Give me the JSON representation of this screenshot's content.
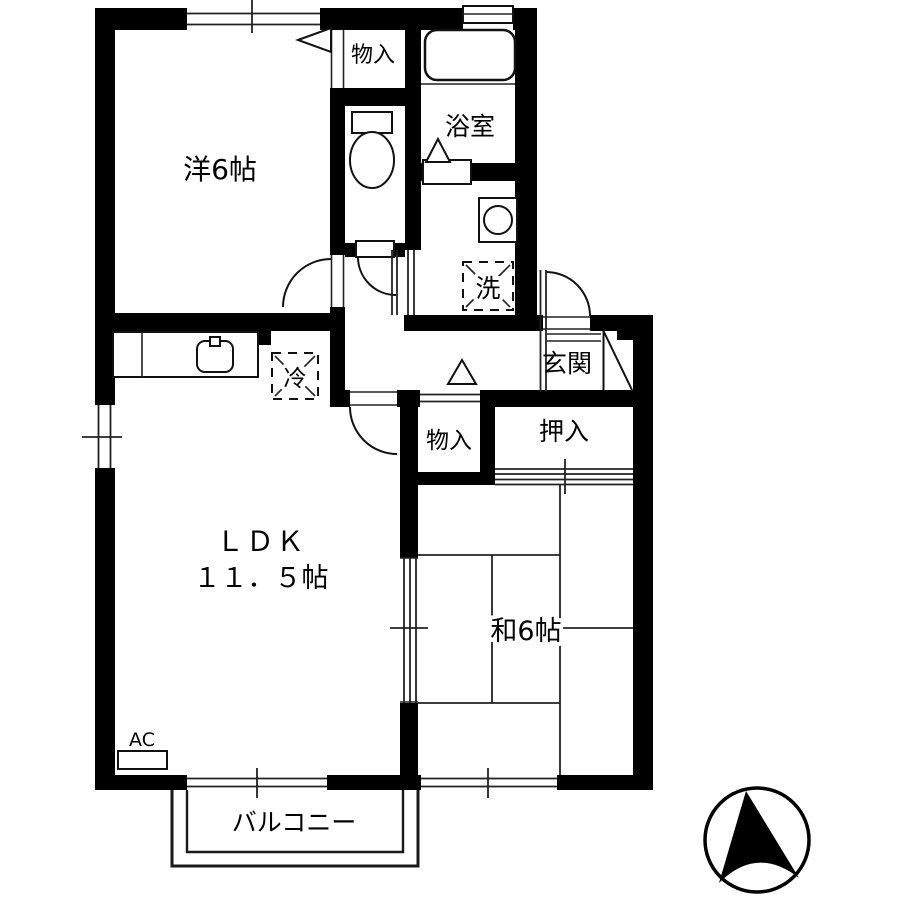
{
  "plan": {
    "rooms": {
      "western_room": "洋6帖",
      "storage_top": "物入",
      "bathroom": "浴室",
      "washer_space": "洗",
      "refrigerator_space": "冷",
      "entrance": "玄関",
      "storage_hall": "物入",
      "oshiire_closet": "押入",
      "ldk_name": "ＬＤＫ",
      "ldk_size": "１１．５帖",
      "japanese_room": "和6帖",
      "balcony": "バルコニー",
      "air_conditioner": "AC"
    },
    "colors": {
      "wall": "#000000",
      "background": "#ffffff",
      "thin_line": "#1a1a1a"
    }
  }
}
